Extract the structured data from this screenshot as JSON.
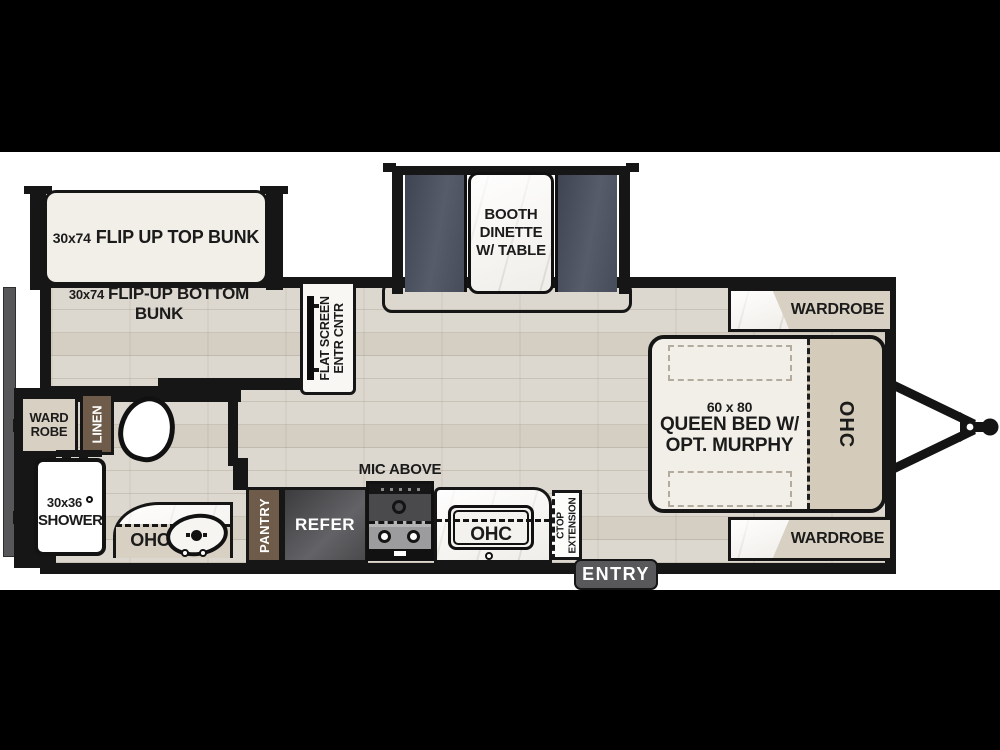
{
  "labels": {
    "top_bunk": {
      "size": "30x74",
      "name": "FLIP UP TOP BUNK"
    },
    "bottom_bunk": {
      "size": "30x74",
      "name": "FLIP-UP BOTTOM BUNK"
    },
    "dinette": {
      "line1": "BOOTH",
      "line2": "DINETTE",
      "line3": "W/ TABLE"
    },
    "entertainment": {
      "line1": "FLAT SCREEN",
      "line2": "ENTR CNTR"
    },
    "wardrobe_rear": {
      "line1": "WARD",
      "line2": "ROBE"
    },
    "linen": "LINEN",
    "shower": {
      "size": "30x36",
      "name": "SHOWER"
    },
    "bath_ohc": "OHC",
    "pantry": "PANTRY",
    "refer": "REFER",
    "mic": "MIC ABOVE",
    "kitchen_ohc": "OHC",
    "ctop": {
      "line1": "CTOP",
      "line2": "EXTENSION"
    },
    "entry": "ENTRY",
    "bed": {
      "size": "60 x 80",
      "line1": "QUEEN BED W/",
      "line2": "OPT. MURPHY"
    },
    "bed_ohc": "OHC",
    "wardrobe_front_top": "WARDROBE",
    "wardrobe_front_bottom": "WARDROBE"
  },
  "colors": {
    "background": "#000000",
    "paper": "#ffffff",
    "wall": "#161616",
    "floor_wood": "#ddd8cf",
    "cabinet_tan": "#d8d0c2",
    "cabinet_brown": "#6f5b49",
    "bench_slate": "#495060",
    "mattress_cream": "#f2efe8",
    "appliance_gray": "#4a4a4c",
    "marble_white": "#f7f6f3",
    "entry_gray": "#58585b"
  }
}
